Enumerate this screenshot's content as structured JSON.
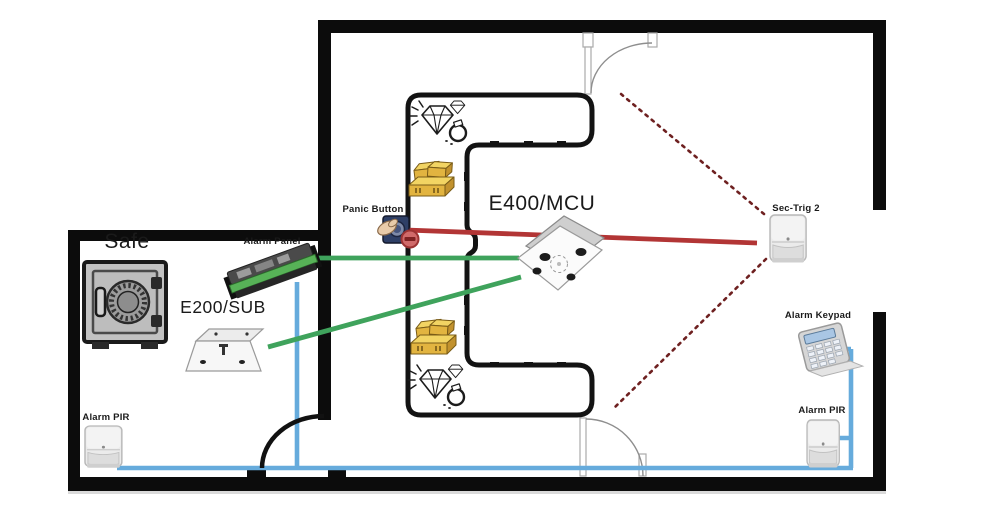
{
  "diagram": {
    "kind": "alarm-system-floor-plan",
    "room": {
      "safe_label": "Safe"
    },
    "devices": {
      "alarm_panel": "Alarm Panel",
      "e200_sub": "E200/SUB",
      "panic_button": "Panic Button",
      "e400_mcu": "E400/MCU",
      "sec_trig_2": "Sec-Trig 2",
      "alarm_keypad": "Alarm Keypad",
      "alarm_pir_right": "Alarm PIR",
      "alarm_pir_left": "Alarm PIR"
    },
    "icons": [
      "safe-icon",
      "pcb-panel-icon",
      "sub-box-icon",
      "panic-button-icon",
      "mcu-ceiling-unit-icon",
      "pir-sensor-icon",
      "keypad-icon",
      "gold-bars-icon",
      "jewels-icon",
      "door-swing-icon"
    ],
    "colors": {
      "wall": "#0c0c0c",
      "bus_line_blue": "#66abdc",
      "trigger_line_red": "#b23535",
      "link_line_green": "#3fa35c",
      "pir_beam_dotted": "#6e2020"
    },
    "connections": [
      {
        "from": "Panic Button",
        "to": "Sec-Trig 2",
        "color": "#b23535",
        "style": "solid"
      },
      {
        "from": "Alarm Panel",
        "to": "E400/MCU",
        "color": "#3fa35c",
        "style": "solid"
      },
      {
        "from": "E200/SUB",
        "to": "E400/MCU",
        "color": "#3fa35c",
        "style": "solid"
      },
      {
        "from": "Alarm Panel",
        "to": "Alarm PIR",
        "color": "#66abdc",
        "style": "solid"
      },
      {
        "from": "Alarm Keypad",
        "to": "Alarm PIR",
        "color": "#66abdc",
        "style": "solid"
      },
      {
        "from": "Sec-Trig 2",
        "to": "top door",
        "color": "#6e2020",
        "style": "dotted"
      },
      {
        "from": "Sec-Trig 2",
        "to": "bottom door",
        "color": "#6e2020",
        "style": "dotted"
      }
    ]
  }
}
